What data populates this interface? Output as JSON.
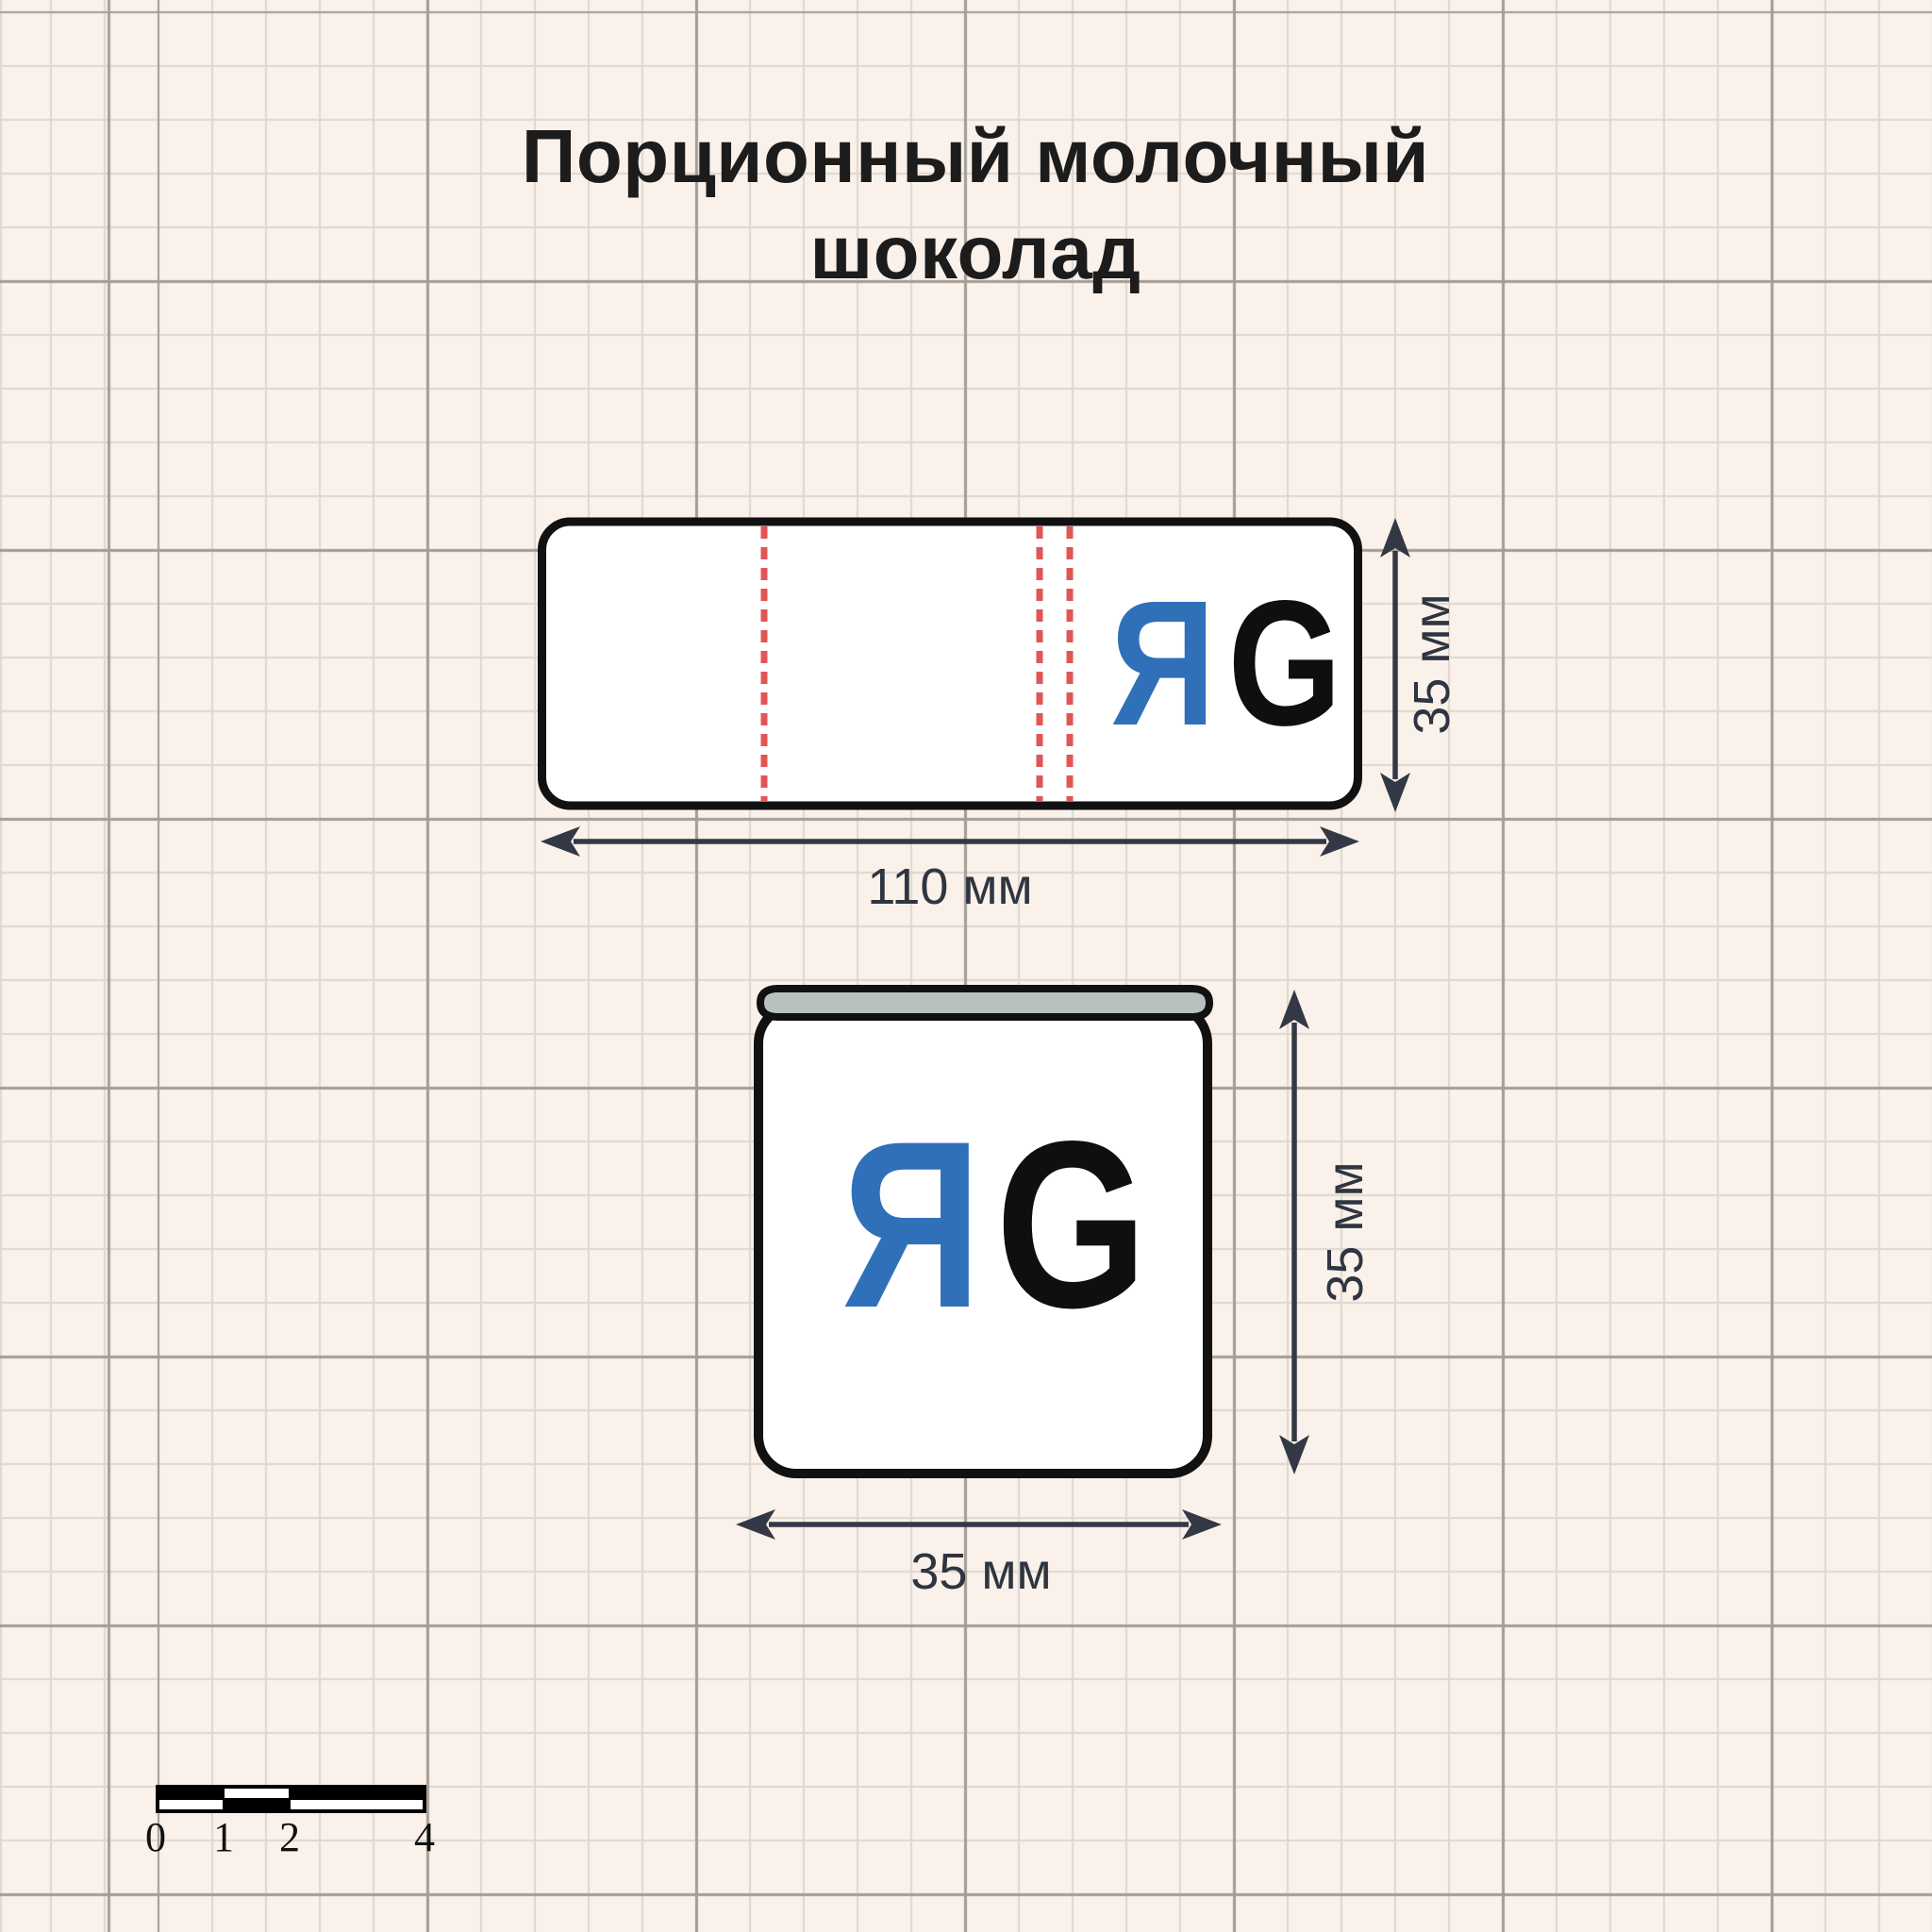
{
  "title": {
    "line1": "Порционный молочный",
    "line2": "шоколад"
  },
  "colors": {
    "background": "#faf1ea",
    "grid_minor": "#ddd6cf",
    "grid_major": "#a39d97",
    "outline_black": "#111111",
    "logo_blue": "#2f70b8",
    "logo_black": "#0f0f0f",
    "fold_dash_red": "#e25555",
    "dimension_arrow": "#333845",
    "wrap_top_gray": "#b7c2be",
    "fill_white": "#ffffff"
  },
  "wrapper": {
    "name": "wrapper-flat-layout",
    "width_label": "110 мм",
    "height_label": "35 мм",
    "logo": {
      "left_letter": "Я",
      "right_letter": "G"
    }
  },
  "piece": {
    "name": "wrapped-chocolate-piece",
    "width_label": "35 мм",
    "height_label": "35 мм",
    "logo": {
      "left_letter": "Я",
      "right_letter": "G"
    }
  },
  "scale_bar": {
    "ticks": [
      "0",
      "1",
      "2",
      "4"
    ]
  }
}
